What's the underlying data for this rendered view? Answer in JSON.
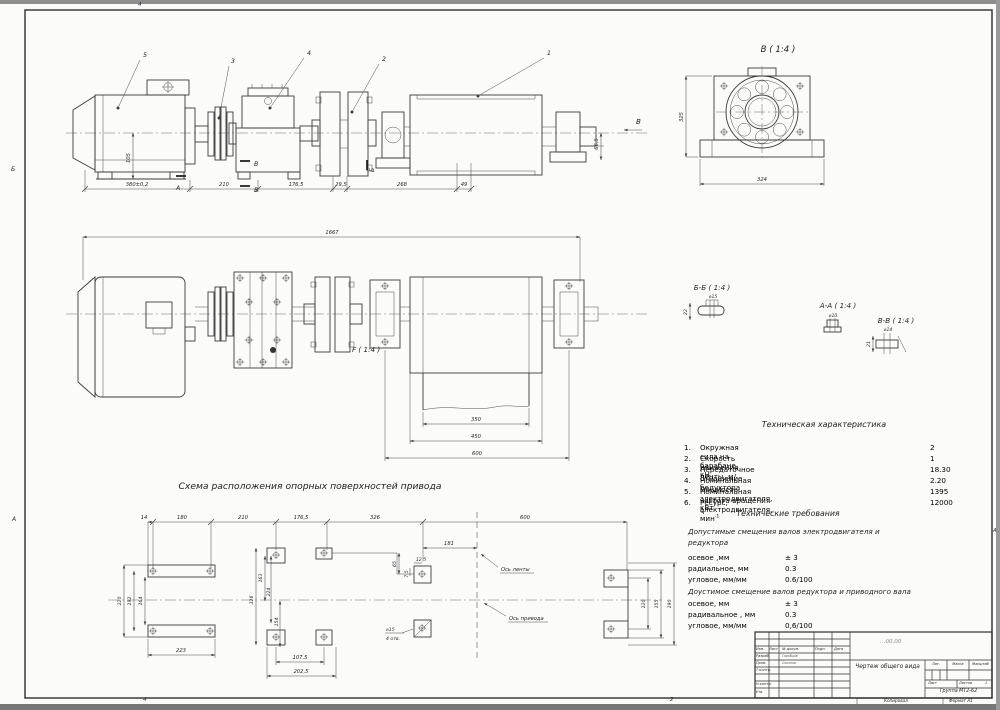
{
  "frame": {
    "zones": {
      "top4": "4",
      "bottom4": "4",
      "bottom2": "2",
      "left_b": "Б",
      "left_a": "А",
      "right_a": "А"
    }
  },
  "side_view": {
    "callout_1": "1",
    "callout_2": "2",
    "callout_3": "3",
    "callout_4": "4",
    "callout_5": "5",
    "arrow_b": "В",
    "sec_a": "А",
    "sec_v1": "В",
    "sec_v2": "В",
    "sec_b": "Б",
    "dim_motor_len": "380±0,2",
    "dim_210": "210",
    "dim_176_5": "176,5",
    "dim_29_5": "29,5",
    "dim_268": "268",
    "dim_49": "49",
    "dim_105": "105",
    "dim_66_5": "66,5"
  },
  "view_b": {
    "title": "В ( 1:4 )",
    "dim_h": "325",
    "dim_w": "324"
  },
  "plan_view": {
    "dim_overall": "1667",
    "label_f": "F ( 1:4 )",
    "dim_350": "350",
    "dim_450": "450",
    "dim_600": "600"
  },
  "sections": {
    "bb_title": "Б-Б ( 1:4 )",
    "bb_dia": "⌀15",
    "bb_h": "22",
    "aa_title": "А-А ( 1:4 )",
    "aa_dia": "⌀10",
    "vv_title": "В-В ( 1:4 )",
    "vv_dia": "⌀14",
    "vv_h": "21"
  },
  "scheme": {
    "title": "Схема расположения опорных поверхностей привода",
    "axis_belt": "Ось ленты",
    "axis_drive": "Ось привода",
    "hole_note_line1": "⌀15",
    "hole_note_line2": "4 отв.",
    "top_dims": {
      "d14": "14",
      "d180": "180",
      "d210": "210",
      "d176": "176,5",
      "d326": "326",
      "d600": "600",
      "d181": "181"
    },
    "motor": {
      "d220": "220",
      "d192": "192",
      "d164": "164",
      "d223": "223"
    },
    "gearbox": {
      "d163": "163",
      "d224": "224",
      "d326": "326",
      "d154": "154",
      "d107": "107,5",
      "d202": "202,5"
    },
    "pads": {
      "d12": "12,5",
      "d7": "7,5",
      "d65": "65"
    },
    "drum": {
      "d120": "120",
      "d155": "155",
      "d190": "190"
    }
  },
  "tech_chars": {
    "title": "Техническая характеристика",
    "items": [
      {
        "n": "1.",
        "label": "Окружная сила на барабане, кН",
        "sup": "",
        "value": "2"
      },
      {
        "n": "2.",
        "label": "Скорость движения ленты, м/с",
        "sup": "",
        "value": "1"
      },
      {
        "n": "3.",
        "label": "Передаточное  отношение редуктора",
        "sup": "",
        "value": "18.30"
      },
      {
        "n": "4.",
        "label": "Номинальная мощность электродвигателя, кВт",
        "sup": "",
        "value": "2.20"
      },
      {
        "n": "5.",
        "label": "Номинальная частота вращения электродвигателя, мин",
        "sup": "-1",
        "value": "1395"
      },
      {
        "n": "6.",
        "label": "Ресурс, ч",
        "sup": "",
        "value": "12000"
      }
    ]
  },
  "tech_reqs": {
    "title": "Технические требования",
    "h1": "Допустимые смещения валов электродвигателя и редуктора",
    "g1": [
      [
        "осевое ,мм",
        "± 3"
      ],
      [
        "радиальное, мм",
        "0.3"
      ],
      [
        "угловое, мм/мм",
        "0.6/100"
      ]
    ],
    "h2": "Доустимое смещение валов редуктора и приводного вала",
    "g2": [
      [
        "осевое, мм",
        "± 3"
      ],
      [
        "радивальное , мм",
        "0.3"
      ],
      [
        "угловое, мм/мм",
        "0,6/100"
      ]
    ]
  },
  "title_block": {
    "doc_no": "…00.00",
    "cols": {
      "izm": "Изм.",
      "list": "Лист",
      "doc": "№ докум.",
      "podp": "Подп.",
      "data": "Дата"
    },
    "rows": {
      "razrab": "Разраб.",
      "prov": "Пров.",
      "tkontr": "Т.контр.",
      "nkontr": "Н.контр.",
      "utv": "Утв."
    },
    "names": {
      "razrab": "Горобцов",
      "prov": "Соколов"
    },
    "title": "Чертеж общего вида",
    "lit": "Лит.",
    "massa": "Масса",
    "masshtab": "Масштаб",
    "list_label": "Лист",
    "listov_label": "Листов",
    "listov_value": "1",
    "org": "Группа МТ2-62",
    "kopiroval": "Копировал",
    "format": "Формат А1"
  }
}
